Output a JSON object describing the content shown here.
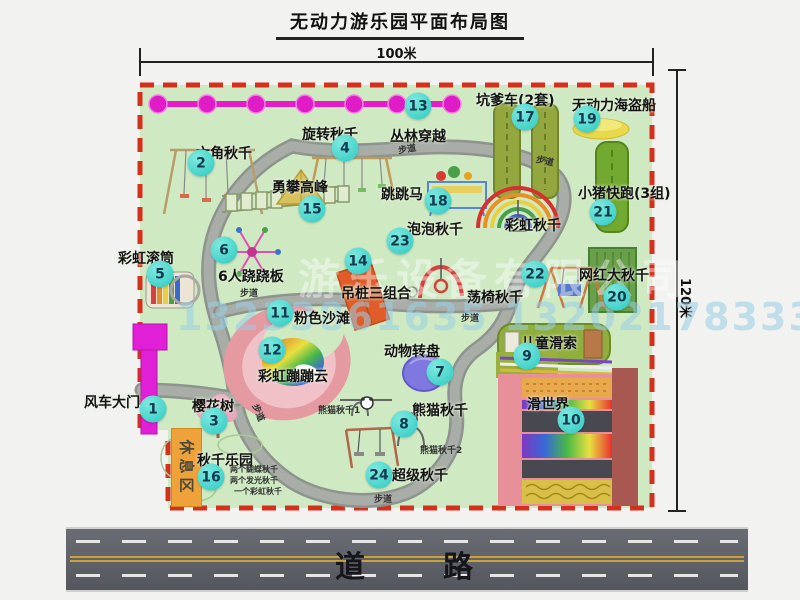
{
  "title": "无动力游乐园平面布局图",
  "dimension_top": "100米",
  "dimension_right": "120米",
  "road_label": "道　　路",
  "rest_area_label": "休息区",
  "watermark": {
    "company": "游乐设备有限公司",
    "phones": "13233861635 13202178333"
  },
  "colors": {
    "park_green": "#cfe9c3",
    "border_red": "#d4301c",
    "marker_cyan": "#2cc9c1",
    "gate_magenta": "#e11fd6",
    "zipline_magenta": "#e61cc8",
    "rest_orange": "#f0a23a",
    "path_gray": "#a0a5a0",
    "road_gray": "#5f616b"
  },
  "map_icons": [
    "windmill-gate-icon",
    "hexagon-swing-icon",
    "cherry-tree-icon",
    "rotary-swing-icon",
    "rainbow-roller-icon",
    "seesaw-spinner-icon",
    "animal-carousel-icon",
    "panda-swing-icon",
    "kids-zipline-icon",
    "slide-world-icon",
    "pink-beach-icon",
    "rainbow-bounce-cloud-icon",
    "jungle-crossing-zipline-icon",
    "hanging-post-icon",
    "climbing-bridge-icon",
    "swing-park-icon",
    "pit-cart-icon",
    "jump-horse-icon",
    "pirate-ship-icon",
    "big-swing-panel-icon",
    "pig-run-track-icon",
    "chair-swing-icon",
    "bubble-swing-arch-icon",
    "super-swing-frame-icon",
    "rainbow-swing-arcs-icon"
  ],
  "attractions": [
    {
      "num": "1",
      "name": "风车大门",
      "label": [
        84,
        392
      ],
      "circle": [
        153,
        409
      ]
    },
    {
      "num": "2",
      "name": "六角秋千",
      "label": [
        196,
        143
      ],
      "circle": [
        201,
        163
      ]
    },
    {
      "num": "3",
      "name": "樱花树",
      "label": [
        192,
        396
      ],
      "circle": [
        214,
        421
      ]
    },
    {
      "num": "4",
      "name": "旋转秋千",
      "label": [
        302,
        124
      ],
      "circle": [
        345,
        148
      ]
    },
    {
      "num": "5",
      "name": "彩虹滚筒",
      "label": [
        118,
        248
      ],
      "circle": [
        160,
        274
      ]
    },
    {
      "num": "6",
      "name": "6人跷跷板",
      "label": [
        218,
        266
      ],
      "circle": [
        224,
        250
      ]
    },
    {
      "num": "7",
      "name": "动物转盘",
      "label": [
        384,
        341
      ],
      "circle": [
        440,
        372
      ]
    },
    {
      "num": "8",
      "name": "熊猫秋千",
      "label": [
        412,
        400
      ],
      "circle": [
        404,
        424
      ]
    },
    {
      "num": "9",
      "name": "儿童滑索",
      "label": [
        521,
        333
      ],
      "circle": [
        527,
        356
      ]
    },
    {
      "num": "10",
      "name": "滑世界",
      "label": [
        527,
        394
      ],
      "circle": [
        571,
        420
      ]
    },
    {
      "num": "11",
      "name": "粉色沙滩",
      "label": [
        294,
        308
      ],
      "circle": [
        280,
        313
      ]
    },
    {
      "num": "12",
      "name": "彩虹蹦蹦云",
      "label": [
        258,
        366
      ],
      "circle": [
        272,
        350
      ]
    },
    {
      "num": "13",
      "name": "丛林穿越",
      "label": [
        390,
        126
      ],
      "circle": [
        418,
        106
      ]
    },
    {
      "num": "14",
      "name": "吊桩三组合",
      "label": [
        341,
        283
      ],
      "circle": [
        358,
        261
      ]
    },
    {
      "num": "15",
      "name": "勇攀高峰",
      "label": [
        272,
        177
      ],
      "circle": [
        312,
        209
      ]
    },
    {
      "num": "16",
      "name": "秋千乐园",
      "label": [
        197,
        450
      ],
      "circle": [
        211,
        477
      ]
    },
    {
      "num": "17",
      "name": "坑爹车(2套)",
      "label": [
        476,
        90
      ],
      "circle": [
        525,
        117
      ]
    },
    {
      "num": "18",
      "name": "跳跳马",
      "label": [
        381,
        184
      ],
      "circle": [
        438,
        201
      ]
    },
    {
      "num": "19",
      "name": "无动力海盗船",
      "label": [
        572,
        95
      ],
      "circle": [
        587,
        119
      ]
    },
    {
      "num": "20",
      "name": "网红大秋千",
      "label": [
        579,
        265
      ],
      "circle": [
        617,
        297
      ]
    },
    {
      "num": "21",
      "name": "小猪快跑(3组)",
      "label": [
        578,
        183
      ],
      "circle": [
        603,
        212
      ]
    },
    {
      "num": "22",
      "name": "荡椅秋千",
      "label": [
        467,
        287
      ],
      "circle": [
        535,
        274
      ]
    },
    {
      "num": "23",
      "name": "泡泡秋千",
      "label": [
        407,
        219
      ],
      "circle": [
        400,
        241
      ]
    },
    {
      "num": "24",
      "name": "超级秋千",
      "label": [
        392,
        465
      ],
      "circle": [
        379,
        475
      ]
    }
  ],
  "extra_labels": [
    {
      "text": "彩虹秋千",
      "x": 505,
      "y": 215,
      "size": 14,
      "bold": true
    },
    {
      "text": "熊猫秋千1",
      "x": 318,
      "y": 403,
      "size": 9
    },
    {
      "text": "熊猫秋千2",
      "x": 420,
      "y": 443,
      "size": 9
    },
    {
      "text": "两个蝴蝶秋千",
      "x": 230,
      "y": 464,
      "size": 8
    },
    {
      "text": "两个发光秋千",
      "x": 230,
      "y": 475,
      "size": 8
    },
    {
      "text": "一个彩虹秋千",
      "x": 234,
      "y": 486,
      "size": 8
    },
    {
      "text": "步道",
      "x": 398,
      "y": 142,
      "size": 9,
      "rot": -10
    },
    {
      "text": "步道",
      "x": 536,
      "y": 154,
      "size": 9,
      "rot": 12
    },
    {
      "text": "步道",
      "x": 240,
      "y": 286,
      "size": 9,
      "rot": 0
    },
    {
      "text": "步道",
      "x": 461,
      "y": 311,
      "size": 9,
      "rot": 0
    },
    {
      "text": "步道",
      "x": 374,
      "y": 492,
      "size": 9,
      "rot": 0
    },
    {
      "text": "步道",
      "x": 250,
      "y": 406,
      "size": 9,
      "rot": 68
    }
  ]
}
